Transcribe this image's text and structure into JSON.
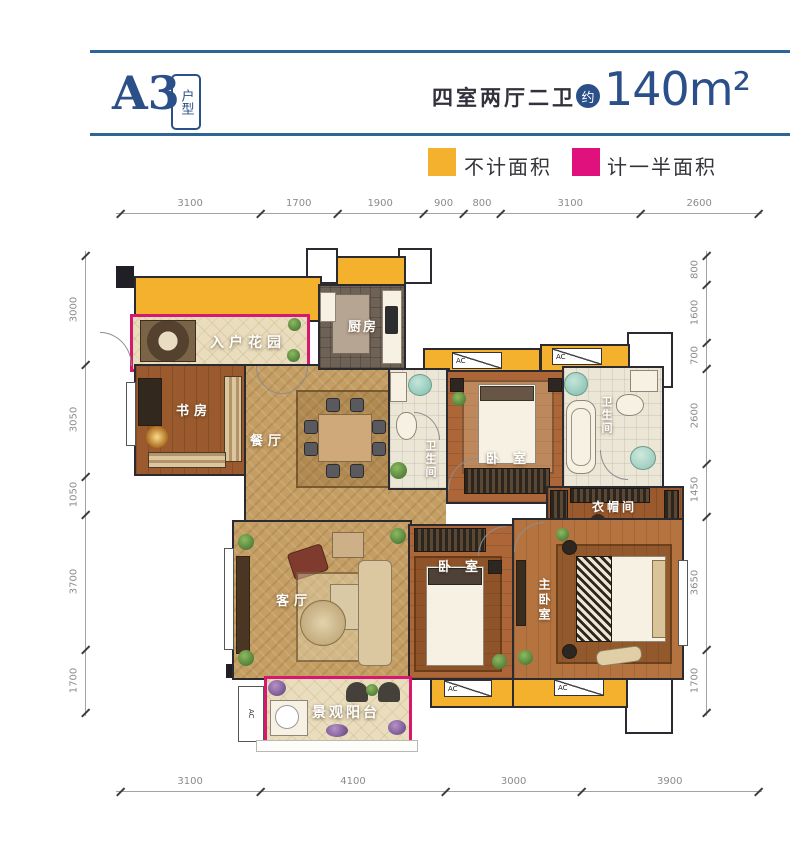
{
  "header": {
    "unit_code": "A3",
    "unit_type_label": "户型",
    "layout_label": "四室两厅二卫",
    "approx_label": "约",
    "area_value": "140m²"
  },
  "legend": {
    "not_counted": "不计面积",
    "half_counted": "计一半面积"
  },
  "colors": {
    "accent_blue": "#2b4f88",
    "rule_blue": "#2f6496",
    "area_yellow": "#f4b12d",
    "area_magenta": "#e0117c"
  },
  "rooms": {
    "entry_garden": "入户花园",
    "study": "书房",
    "dining": "餐厅",
    "kitchen": "厨房",
    "bath": "卫生间",
    "bedroom": "卧室",
    "master_bedroom": "主卧室",
    "cloakroom": "衣帽间",
    "living": "客厅",
    "balcony": "景观阳台",
    "ac": "AC"
  },
  "dimensions": {
    "top": [
      3100,
      1700,
      1900,
      900,
      800,
      3100,
      2600
    ],
    "bottom": [
      3100,
      4100,
      3000,
      3900
    ],
    "left": [
      3000,
      3050,
      1050,
      3700,
      1700
    ],
    "right": [
      800,
      1600,
      700,
      2600,
      1450,
      3650,
      1700
    ]
  }
}
